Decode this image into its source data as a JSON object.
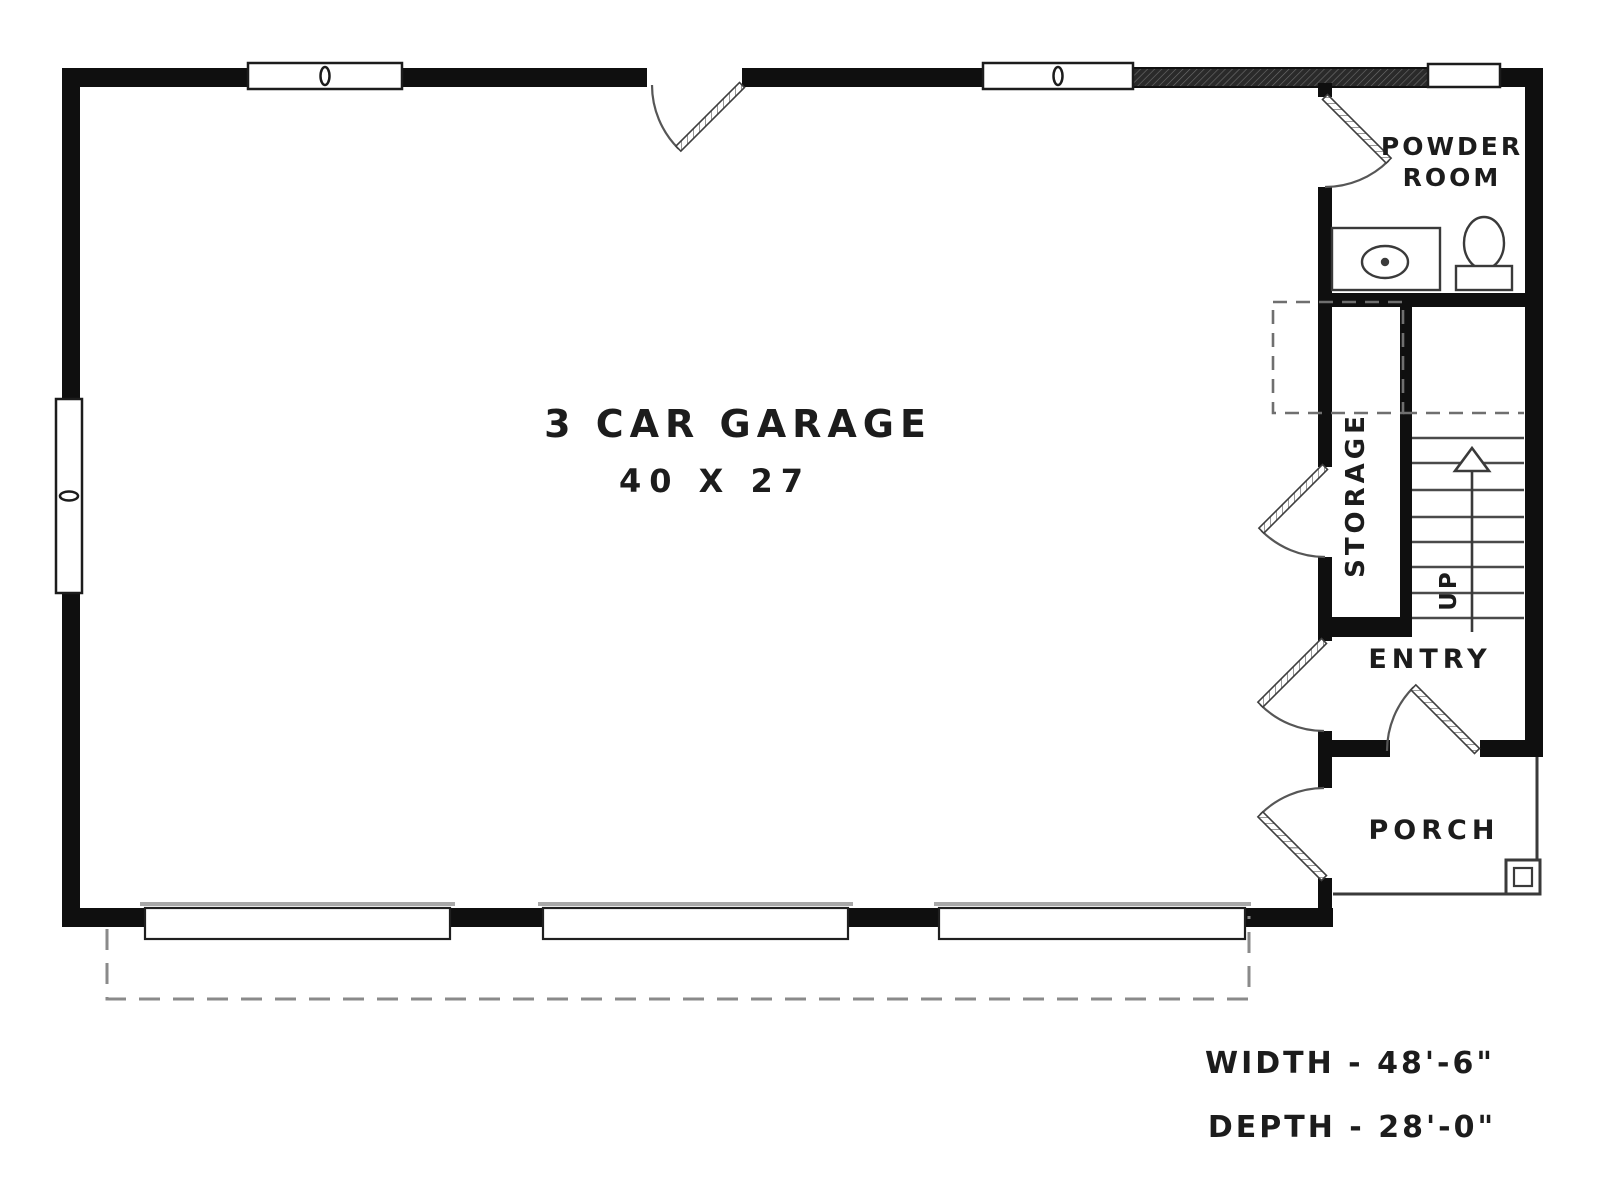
{
  "plan": {
    "title": "3 Car Garage Floor Plan",
    "rooms": {
      "garage_label": "3 CAR GARAGE",
      "garage_size": "40 X 27",
      "powder_line1": "POWDER",
      "powder_line2": "ROOM",
      "storage": "STORAGE",
      "entry": "ENTRY",
      "porch": "PORCH",
      "stairs_up": "UP"
    },
    "dimensions": {
      "width": "WIDTH - 48'-6\"",
      "depth": "DEPTH - 28'-0\""
    },
    "colors": {
      "wall": "#0f0f0f",
      "line": "#3a3a3a",
      "light_gray": "#a8a8a8",
      "dash_gray": "#8a8a8a",
      "background": "#ffffff"
    }
  }
}
